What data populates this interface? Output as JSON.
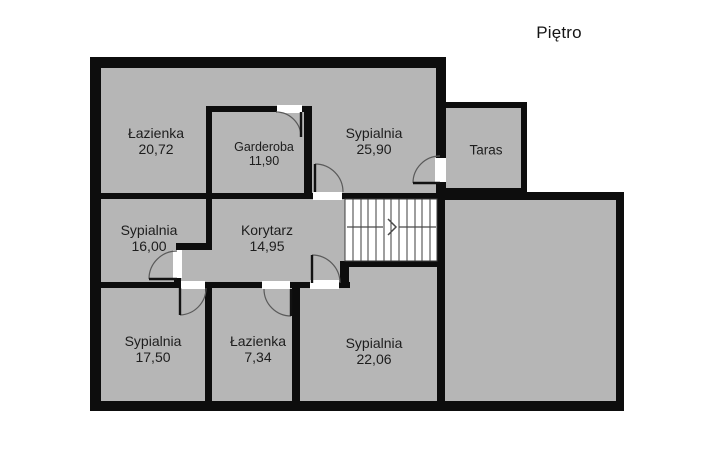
{
  "title": "Piętro",
  "plan": {
    "colors": {
      "wall": "#0d0d0d",
      "room_fill": "#b6b6b6",
      "door_opening": "#ffffff",
      "stairs_fill": "#ffffff",
      "text": "#1d1d1d",
      "background": "#ffffff"
    },
    "rooms": [
      {
        "id": "lazienka-top",
        "name": "Łazienka",
        "area": "20,72"
      },
      {
        "id": "garderoba",
        "name": "Garderoba",
        "area": "11,90"
      },
      {
        "id": "sypialnia-top",
        "name": "Sypialnia",
        "area": "25,90"
      },
      {
        "id": "taras",
        "name": "Taras"
      },
      {
        "id": "sypialnia-mid",
        "name": "Sypialnia",
        "area": "16,00"
      },
      {
        "id": "korytarz",
        "name": "Korytarz",
        "area": "14,95"
      },
      {
        "id": "sypialnia-bottom-left",
        "name": "Sypialnia",
        "area": "17,50"
      },
      {
        "id": "lazienka-bottom",
        "name": "Łazienka",
        "area": "7,34"
      },
      {
        "id": "sypialnia-bottom-mid",
        "name": "Sypialnia",
        "area": "22,06"
      }
    ],
    "icons": {
      "stairs_direction_arrow": "›"
    }
  }
}
